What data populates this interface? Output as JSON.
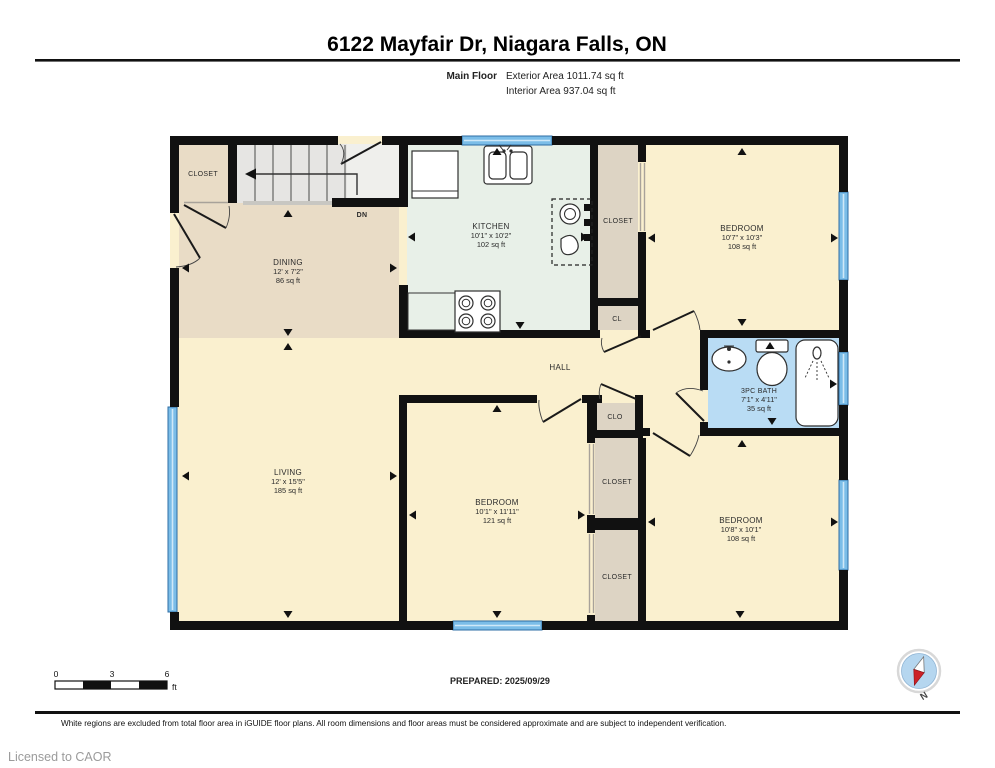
{
  "header": {
    "title": "6122 Mayfair Dr, Niagara Falls, ON",
    "floor_label": "Main Floor",
    "exterior_area": "Exterior Area 1011.74 sq ft",
    "interior_area": "Interior Area 937.04 sq ft"
  },
  "rooms": {
    "entry_closet": {
      "name": "CLOSET"
    },
    "dining": {
      "name": "DINING",
      "dims": "12' x 7'2\"",
      "area": "86 sq ft"
    },
    "kitchen": {
      "name": "KITCHEN",
      "dims": "10'1\" x 10'2\"",
      "area": "102 sq ft"
    },
    "kitchen_closet": {
      "name": "CLOSET"
    },
    "cl_closet": {
      "name": "CL"
    },
    "bedroom_ne": {
      "name": "BEDROOM",
      "dims": "10'7\" x 10'3\"",
      "area": "108 sq ft"
    },
    "hall": {
      "name": "HALL"
    },
    "bath": {
      "name": "3PC BATH",
      "dims": "7'1\" x 4'11\"",
      "area": "35 sq ft"
    },
    "clo_closet": {
      "name": "CLO"
    },
    "living": {
      "name": "LIVING",
      "dims": "12' x 15'5\"",
      "area": "185 sq ft"
    },
    "bedroom_s": {
      "name": "BEDROOM",
      "dims": "10'1\" x 11'11\"",
      "area": "121 sq ft"
    },
    "closet_s1": {
      "name": "CLOSET"
    },
    "closet_s2": {
      "name": "CLOSET"
    },
    "bedroom_se": {
      "name": "BEDROOM",
      "dims": "10'8\" x 10'1\"",
      "area": "108 sq ft"
    }
  },
  "stairs": {
    "label": "DN"
  },
  "scale_bar": {
    "tick_0": "0",
    "tick_3": "3",
    "tick_6": "6",
    "unit": "ft"
  },
  "compass": {
    "label": "N"
  },
  "footer": {
    "prepared": "PREPARED: 2025/09/29",
    "disclaimer": "White regions are excluded from total floor area in iGUIDE floor plans. All room dimensions and floor areas must be considered approximate and are subject to independent verification.",
    "license": "Licensed to CAOR"
  },
  "colors": {
    "wall": "#111111",
    "room_yellow": "#faf0cf",
    "dining_tan": "#e9dcc6",
    "kitchen_mint": "#e8f0e8",
    "closet_gray": "#ddd4c4",
    "bath_blue": "#b9dcf4",
    "window_blue": "#7bbde8",
    "stairs_gray": "#e8e7e5",
    "compass_red": "#cc2127"
  }
}
